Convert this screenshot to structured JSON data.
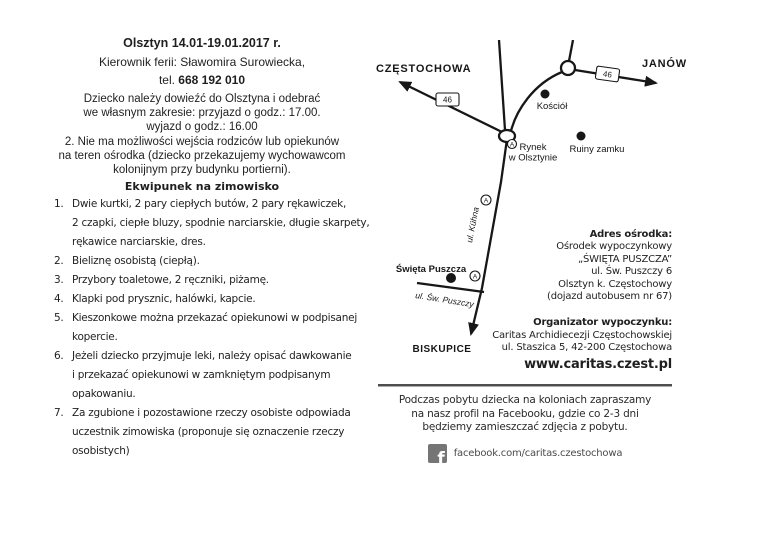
{
  "page": {
    "background": "#ffffff",
    "text_color": "#1f1f1f"
  },
  "header": {
    "title": "Olsztyn 14.01-19.01.2017 r.",
    "manager": "Kierownik ferii: Sławomira Surowiecka,",
    "tel_label": "tel. ",
    "tel_number": "668 192 010"
  },
  "intro": "Dziecko należy dowieźć do Olsztyna i odebrać\nwe własnym zakresie: przyjazd o godz.: 17.00.\nwyjazd o godz.: 16.00\n2. Nie ma możliwości wejścia rodziców lub opiekunów\nna teren ośrodka (dziecko przekazujemy wychowawcom\nkolonijnym przy budynku portierni).",
  "equipment": {
    "heading": "Ekwipunek na zimowisko",
    "items": [
      {
        "num": "1.",
        "text": "Dwie kurtki, 2 pary ciepłych butów, 2 pary rękawiczek,\n2 czapki, ciepłe bluzy, spodnie narciarskie, długie skarpety,\nrękawice narciarskie, dres."
      },
      {
        "num": "2.",
        "text": "Bieliznę osobistą (ciepłą)."
      },
      {
        "num": "3.",
        "text": "Przybory toaletowe, 2 ręczniki, piżamę."
      },
      {
        "num": "4.",
        "text": "Klapki pod prysznic, halówki, kapcie."
      },
      {
        "num": "5.",
        "text": "Kieszonkowe można przekazać opiekunowi w podpisanej\nkopercie."
      },
      {
        "num": "6.",
        "text": "Jeżeli dziecko przyjmuje leki, należy opisać dawkowanie\ni przekazać opiekunowi w zamkniętym podpisanym\nopakowaniu."
      },
      {
        "num": "7.",
        "text": "Za zgubione i pozostawione rzeczy osobiste odpowiada\nuczestnik zimowiska (proponuje się oznaczenie rzeczy\nosobistych)"
      }
    ]
  },
  "map": {
    "west_label": "CZĘSTOCHOWA",
    "east_label": "JANÓW",
    "south_label": "BISKUPICE",
    "road_number": "46",
    "church_label": "Kościół",
    "market_line1": "Rynek",
    "market_line2": "w Olsztynie",
    "ruins_label": "Ruiny zamku",
    "resort_label": "Święta Puszcza",
    "street_kuhna": "ul. Kühna",
    "street_puszczy": "ul. Św. Puszczy",
    "bus_stop_letter": "A"
  },
  "address": {
    "heading1": "Adres ośrodka:",
    "resort": "Ośrodek wypoczynkowy\n„ŚWIĘTA PUSZCZA”\nul. Św. Puszczy 6\nOlsztyn k. Częstochowy\n(dojazd autobusem nr 67)",
    "heading2": "Organizator wypoczynku:",
    "organizer": "Caritas Archidiecezji Częstochowskiej\nul. Staszica 5, 42-200 Częstochowa",
    "website": "www.caritas.czest.pl"
  },
  "footer": {
    "note": "Podczas pobytu dziecka na koloniach zapraszamy\nna nasz profil na Facebooku, gdzie co 2-3 dni\nbędziemy zamieszczać zdjęcia z pobytu.",
    "facebook_icon_letter": "f",
    "facebook_url": "facebook.com/caritas.czestochowa"
  }
}
